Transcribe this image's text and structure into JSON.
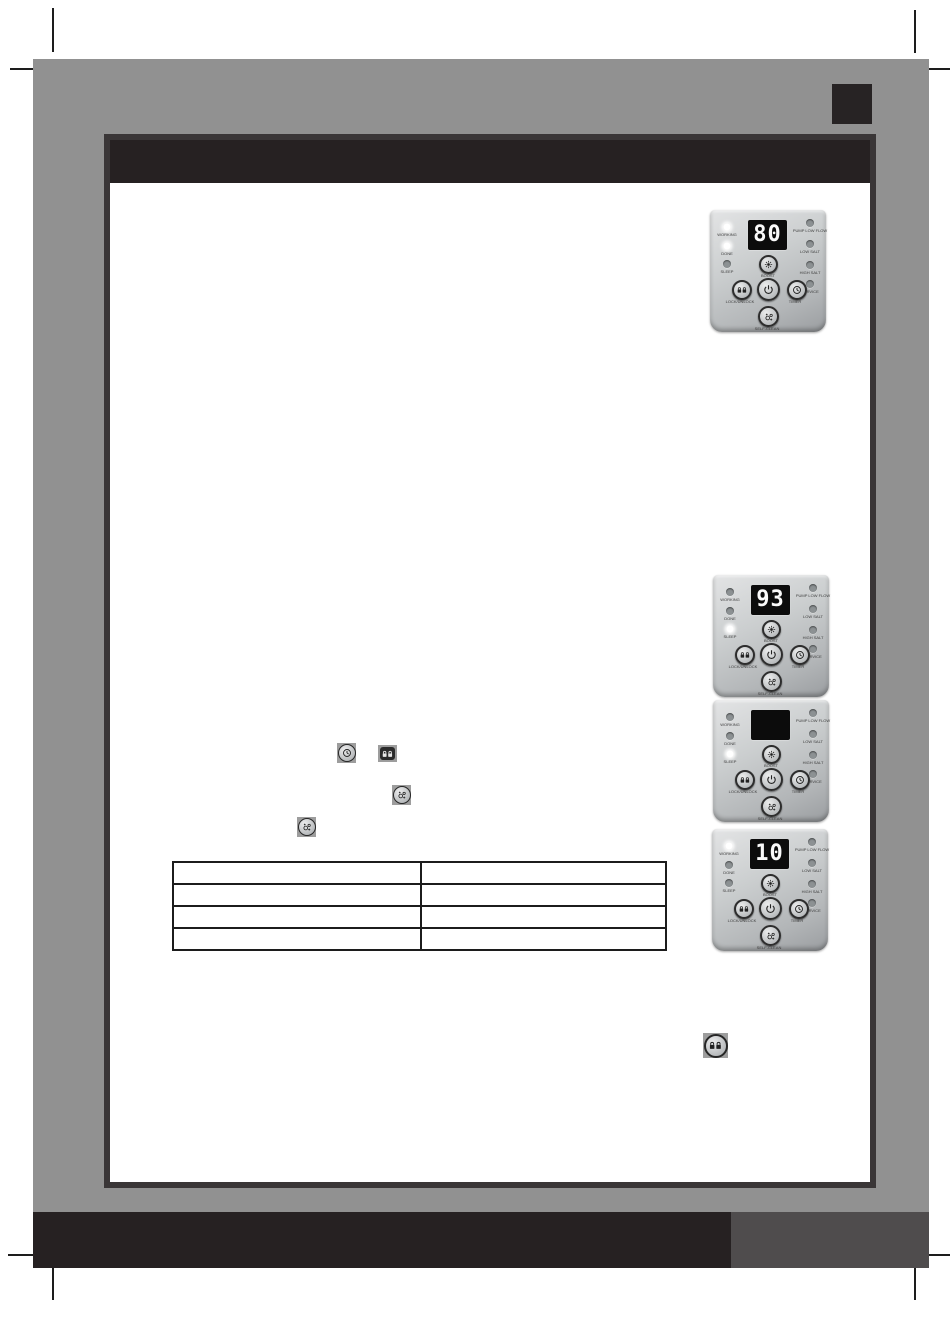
{
  "document": {
    "kind": "scanned-manual-page",
    "header_bar_text": "",
    "footer_text": "",
    "corner_block_text": ""
  },
  "colors": {
    "sheet_gray": "#919191",
    "bar_black": "#262122",
    "footer_accent_gray": "#4f4c4d",
    "content_box_border": "#3a3637",
    "panel_silver": "#c5c8c9",
    "display_background": "#0c0c0c",
    "display_digits": "#fafafa",
    "led_lit": "#ffffff",
    "led_unlit": "#8c9193"
  },
  "panel_labels": {
    "leds_left": [
      "WORKING",
      "DONE",
      "SLEEP"
    ],
    "leds_right": [
      "PUMP LOW FLOW",
      "LOW SALT",
      "HIGH SALT",
      "SERVICE"
    ],
    "buttons": {
      "boost": "BOOST",
      "lock": "LOCK/UNLOCK",
      "timer": "TIMER",
      "self_clean": "SELF-CLEAN"
    }
  },
  "panels": [
    {
      "name": "control-panel-photo-1",
      "display": "80",
      "leds_lit": [
        "working",
        "done"
      ]
    },
    {
      "name": "control-panel-photo-2",
      "display": "93",
      "leds_lit": [
        "sleep"
      ]
    },
    {
      "name": "control-panel-photo-3",
      "display": "",
      "leds_lit": [
        "sleep"
      ]
    },
    {
      "name": "control-panel-photo-4",
      "display": "10",
      "leds_lit": [
        "working"
      ]
    }
  ],
  "inline_icons": [
    {
      "name": "timer-button-icon"
    },
    {
      "name": "lock-unlock-button-icon"
    },
    {
      "name": "self-clean-button-icon"
    },
    {
      "name": "self-clean-button-icon"
    },
    {
      "name": "lock-unlock-button-icon"
    }
  ],
  "table": {
    "rows": 4,
    "cols": 2,
    "cells": [
      [
        "",
        ""
      ],
      [
        "",
        ""
      ],
      [
        "",
        ""
      ],
      [
        "",
        ""
      ]
    ]
  }
}
